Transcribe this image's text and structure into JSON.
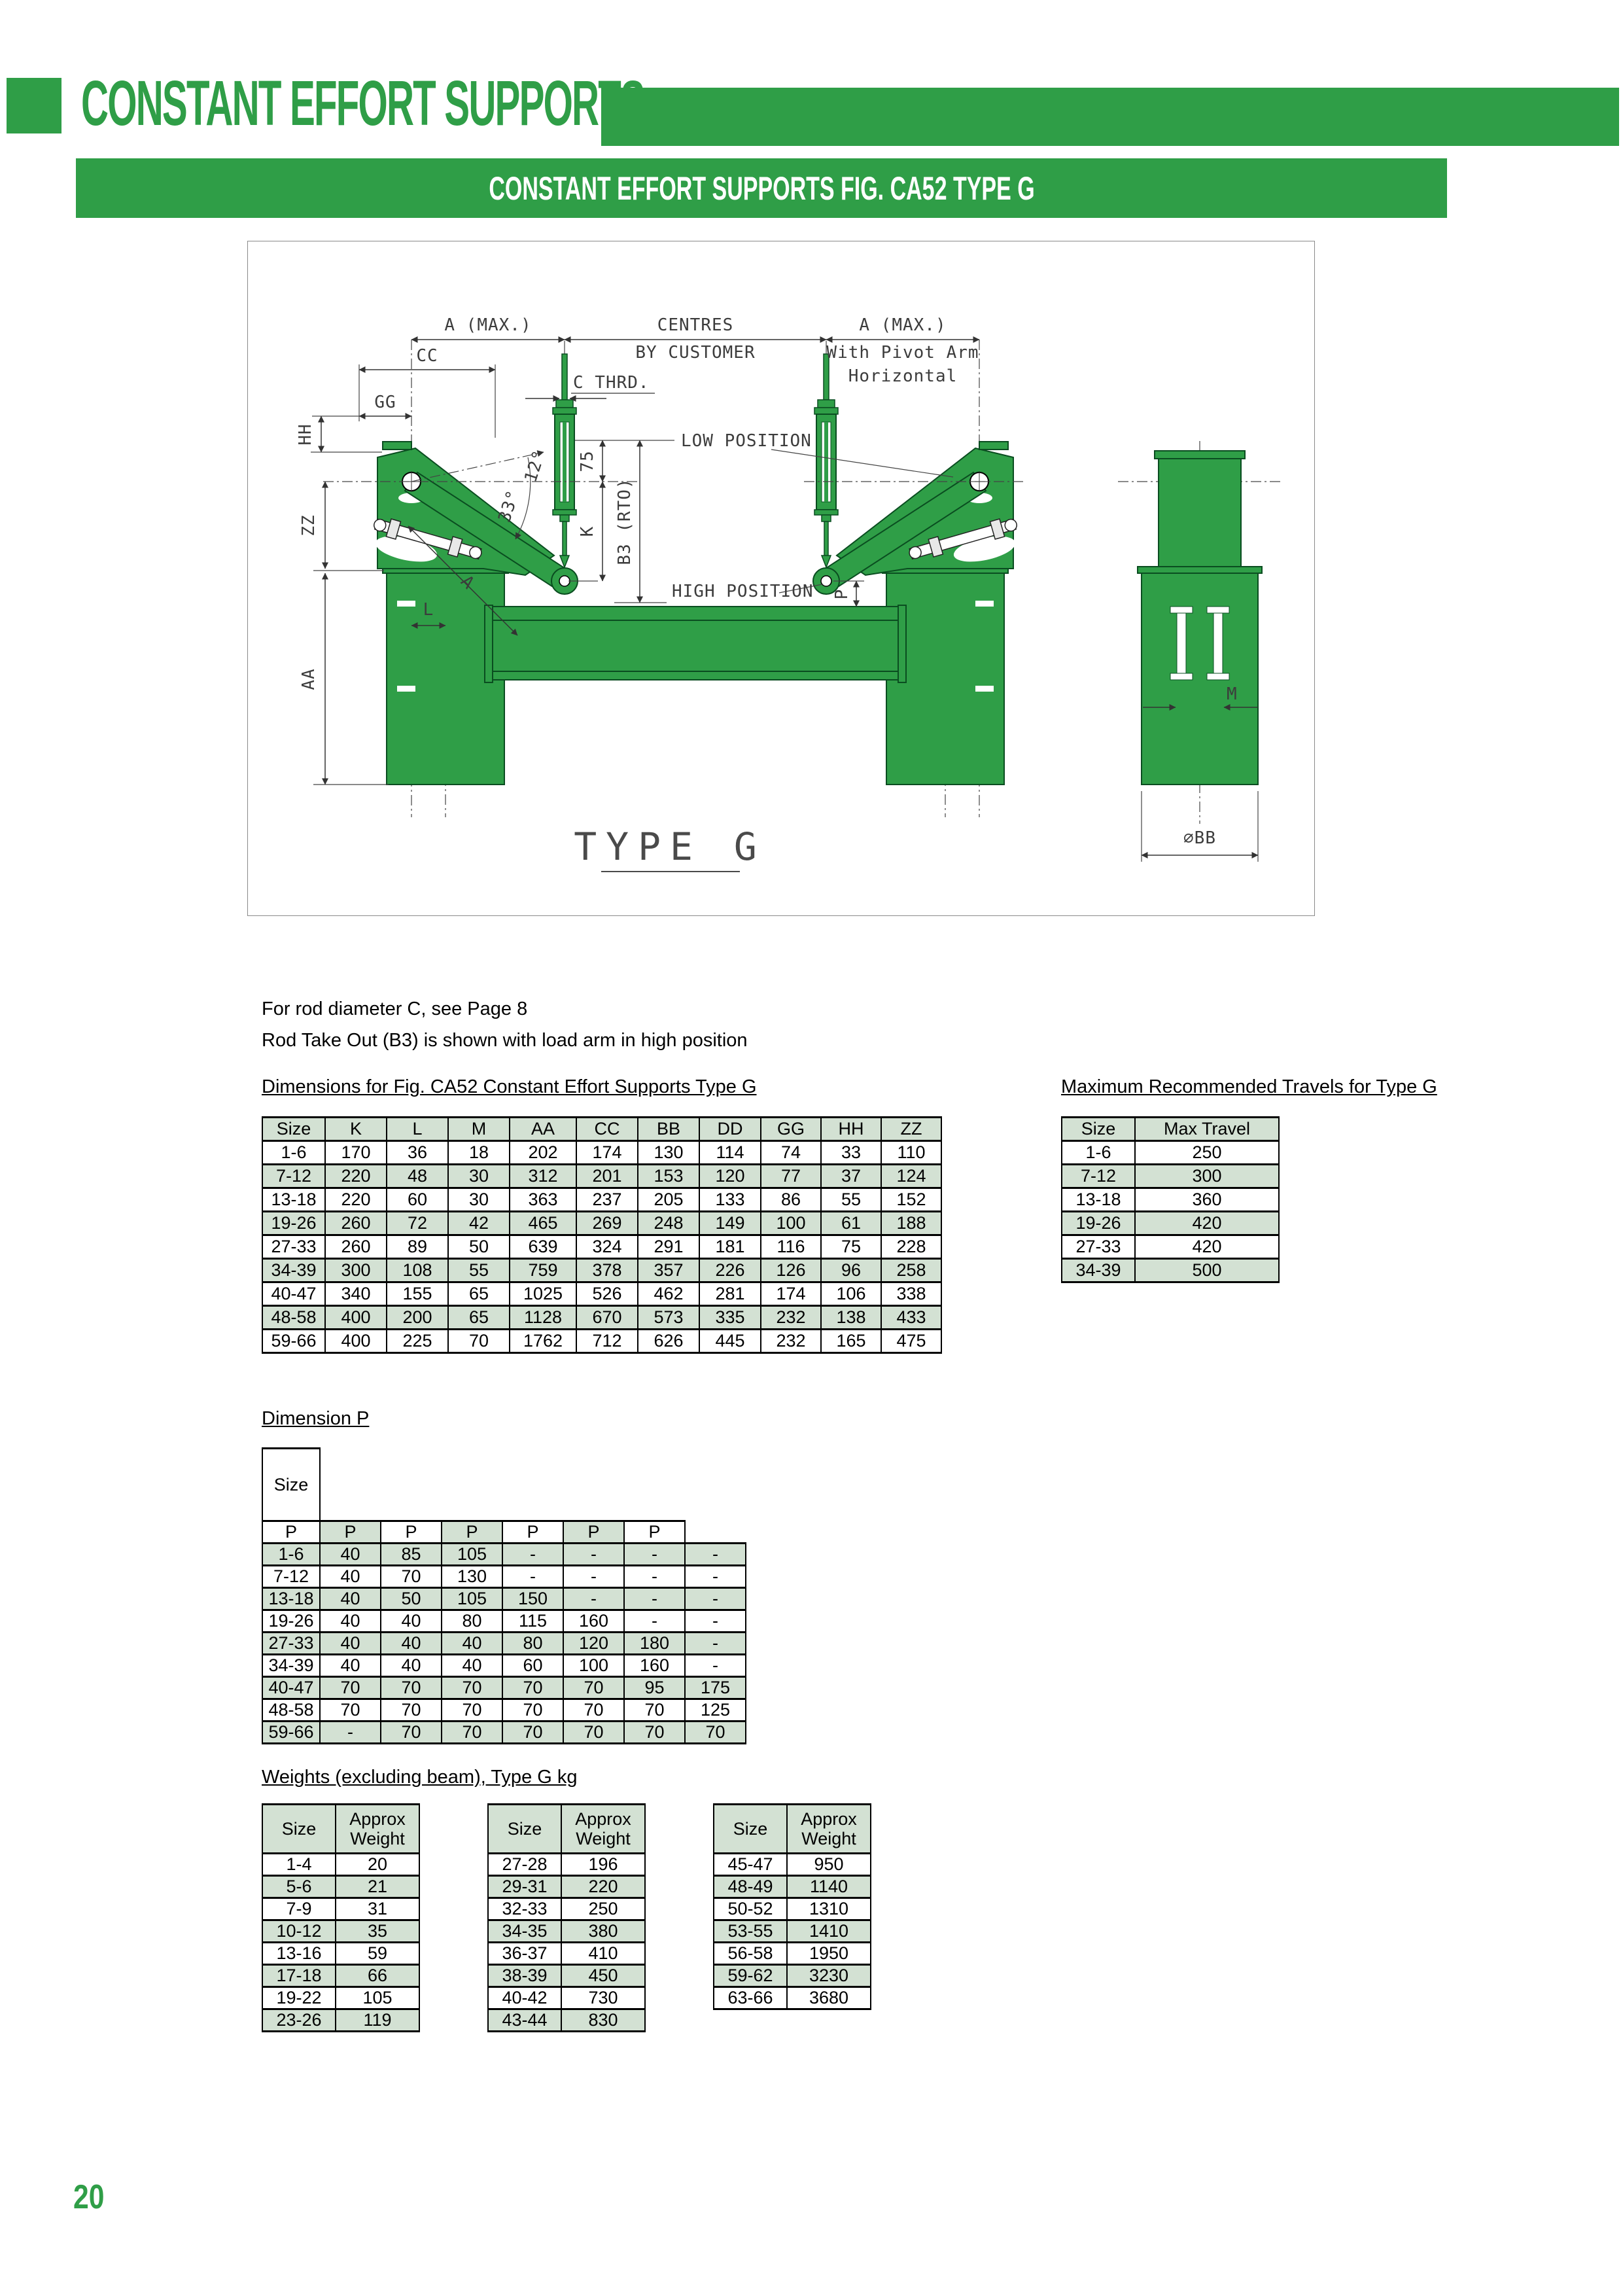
{
  "colors": {
    "accent_green": "#2f9e47",
    "row_stripe_green": "#d3e1d3"
  },
  "header": {
    "title": "CONSTANT EFFORT SUPPORTS",
    "banner": "CONSTANT EFFORT SUPPORTS FIG. CA52 TYPE G"
  },
  "notes": {
    "line1": "For rod diameter C, see Page 8",
    "line2": "Rod Take Out (B3) is shown with load arm in high position"
  },
  "drawing": {
    "caption": "TYPE G",
    "labels": {
      "a_max_left": "A (MAX.)",
      "centres": "CENTRES",
      "by_customer": "BY CUSTOMER",
      "a_max_right": "A (MAX.)",
      "pivot_arm_line1": "With Pivot Arm",
      "pivot_arm_line2": "Horizontal",
      "cc": "CC",
      "c_thrd": "C THRD.",
      "gg": "GG",
      "hh": "HH",
      "zz": "ZZ",
      "aa": "AA",
      "low_position": "LOW POSITION",
      "high_position": "HIGH POSITION",
      "deg12": "12°",
      "deg33": "33°",
      "dim75": "75",
      "k": "K",
      "b3": "B3 (RTO)",
      "l": "L",
      "a": "A",
      "p": "P",
      "m": "M",
      "bb": "∅BB"
    }
  },
  "dim_table": {
    "heading": "Dimensions for Fig. CA52 Constant Effort Supports Type G",
    "columns": [
      "Size",
      "K",
      "L",
      "M",
      "AA",
      "CC",
      "BB",
      "DD",
      "GG",
      "HH",
      "ZZ"
    ],
    "rows": [
      [
        "1-6",
        "170",
        "36",
        "18",
        "202",
        "174",
        "130",
        "114",
        "74",
        "33",
        "110"
      ],
      [
        "7-12",
        "220",
        "48",
        "30",
        "312",
        "201",
        "153",
        "120",
        "77",
        "37",
        "124"
      ],
      [
        "13-18",
        "220",
        "60",
        "30",
        "363",
        "237",
        "205",
        "133",
        "86",
        "55",
        "152"
      ],
      [
        "19-26",
        "260",
        "72",
        "42",
        "465",
        "269",
        "248",
        "149",
        "100",
        "61",
        "188"
      ],
      [
        "27-33",
        "260",
        "89",
        "50",
        "639",
        "324",
        "291",
        "181",
        "116",
        "75",
        "228"
      ],
      [
        "34-39",
        "300",
        "108",
        "55",
        "759",
        "378",
        "357",
        "226",
        "126",
        "96",
        "258"
      ],
      [
        "40-47",
        "340",
        "155",
        "65",
        "1025",
        "526",
        "462",
        "281",
        "174",
        "106",
        "338"
      ],
      [
        "48-58",
        "400",
        "200",
        "65",
        "1128",
        "670",
        "573",
        "335",
        "232",
        "138",
        "433"
      ],
      [
        "59-66",
        "400",
        "225",
        "70",
        "1762",
        "712",
        "626",
        "445",
        "232",
        "165",
        "475"
      ]
    ]
  },
  "travel_table": {
    "heading": "Maximum Recommended Travels for Type G",
    "columns": [
      "Size",
      "Max Travel"
    ],
    "rows": [
      [
        "1-6",
        "250"
      ],
      [
        "7-12",
        "300"
      ],
      [
        "13-18",
        "360"
      ],
      [
        "19-26",
        "420"
      ],
      [
        "27-33",
        "420"
      ],
      [
        "34-39",
        "500"
      ]
    ]
  },
  "dimension_p": {
    "heading": "Dimension P",
    "size_label": "Size",
    "travel_cols": [
      "Travel\n40-140",
      "Travel\n150-\n220",
      "Travel\n230-\n300",
      "Travel\n310-\n360",
      "Travel\n370-\n420",
      "Travel\n430-\n500",
      "Travel\n510-\n610"
    ],
    "p_row": [
      "P",
      "P",
      "P",
      "P",
      "P",
      "P",
      "P"
    ],
    "rows": [
      [
        "1-6",
        "40",
        "85",
        "105",
        "-",
        "-",
        "-",
        "-"
      ],
      [
        "7-12",
        "40",
        "70",
        "130",
        "-",
        "-",
        "-",
        "-"
      ],
      [
        "13-18",
        "40",
        "50",
        "105",
        "150",
        "-",
        "-",
        "-"
      ],
      [
        "19-26",
        "40",
        "40",
        "80",
        "115",
        "160",
        "-",
        "-"
      ],
      [
        "27-33",
        "40",
        "40",
        "40",
        "80",
        "120",
        "180",
        "-"
      ],
      [
        "34-39",
        "40",
        "40",
        "40",
        "60",
        "100",
        "160",
        "-"
      ],
      [
        "40-47",
        "70",
        "70",
        "70",
        "70",
        "70",
        "95",
        "175"
      ],
      [
        "48-58",
        "70",
        "70",
        "70",
        "70",
        "70",
        "70",
        "125"
      ],
      [
        "59-66",
        "-",
        "70",
        "70",
        "70",
        "70",
        "70",
        "70"
      ]
    ]
  },
  "weights": {
    "heading": "Weights (excluding beam), Type G kg",
    "col_size": "Size",
    "col_weight": "Approx\nWeight",
    "tables": [
      {
        "rows": [
          [
            "1-4",
            "20"
          ],
          [
            "5-6",
            "21"
          ],
          [
            "7-9",
            "31"
          ],
          [
            "10-12",
            "35"
          ],
          [
            "13-16",
            "59"
          ],
          [
            "17-18",
            "66"
          ],
          [
            "19-22",
            "105"
          ],
          [
            "23-26",
            "119"
          ]
        ]
      },
      {
        "rows": [
          [
            "27-28",
            "196"
          ],
          [
            "29-31",
            "220"
          ],
          [
            "32-33",
            "250"
          ],
          [
            "34-35",
            "380"
          ],
          [
            "36-37",
            "410"
          ],
          [
            "38-39",
            "450"
          ],
          [
            "40-42",
            "730"
          ],
          [
            "43-44",
            "830"
          ]
        ]
      },
      {
        "rows": [
          [
            "45-47",
            "950"
          ],
          [
            "48-49",
            "1140"
          ],
          [
            "50-52",
            "1310"
          ],
          [
            "53-55",
            "1410"
          ],
          [
            "56-58",
            "1950"
          ],
          [
            "59-62",
            "3230"
          ],
          [
            "63-66",
            "3680"
          ]
        ]
      }
    ]
  },
  "page_number": "20"
}
